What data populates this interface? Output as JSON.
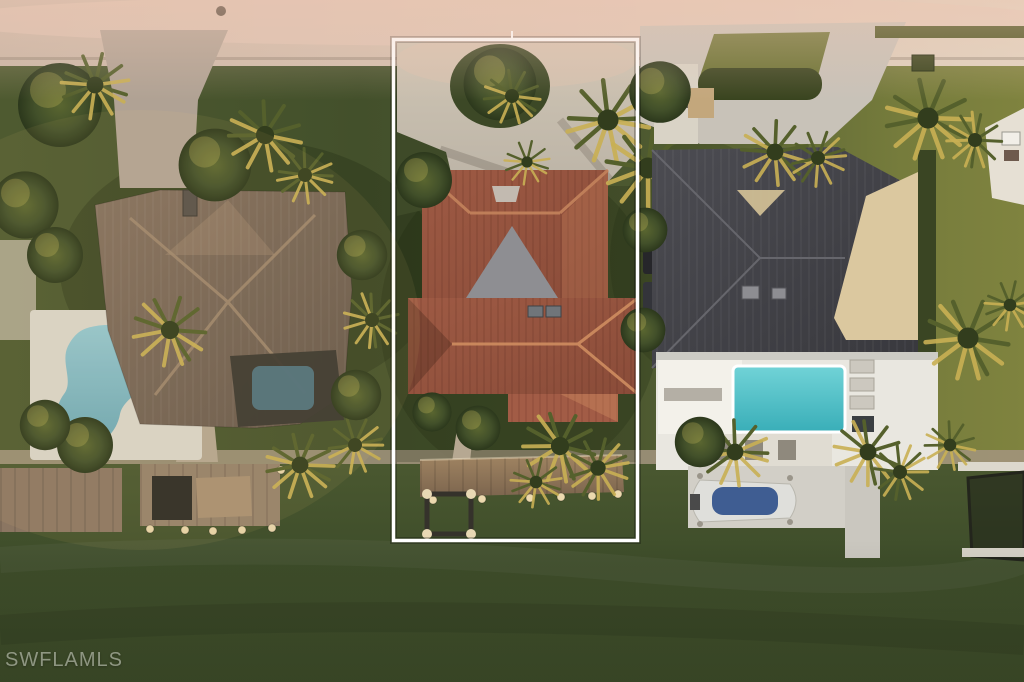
{
  "image": {
    "kind": "aerial-real-estate-photo",
    "watermark": "SWFLAMLS",
    "scene": "Aerial sunset view of three waterfront homes with docks on a dark green canal; the center lot is outlined in white",
    "highlighted_lot": "Center property: terracotta tile roof home, circular paver motor court with island trees, lawn, wooden dock with boat lift",
    "left_lot": "Large brown hip-roof home with kidney-shaped pool, screened lanai pool, paver driveway, dock with boat lift",
    "right_lot": "Charcoal metal roof home with cream flat roof sections, paver drive with hedge island, turquoise pool with white deck, dock with boat on lift, second boat lift"
  },
  "palette": {
    "street": "#d2bfb0",
    "lawn": "#4d5930",
    "lawn_sunlit": "#7c813e",
    "water": "#42512c",
    "left_roof": "#7a695a",
    "center_roof": "#9c5843",
    "center_gable": "#8e8e92",
    "right_roof": "#434348",
    "right_roof_flat": "#dbc89f",
    "left_pool": "#82bac4",
    "right_pool": "#4fc5c9",
    "dock_wood": "#8f7a61",
    "dock_concrete": "#d2cfc7",
    "outline": "#ffffff",
    "palm_gold": "#c9b054"
  }
}
